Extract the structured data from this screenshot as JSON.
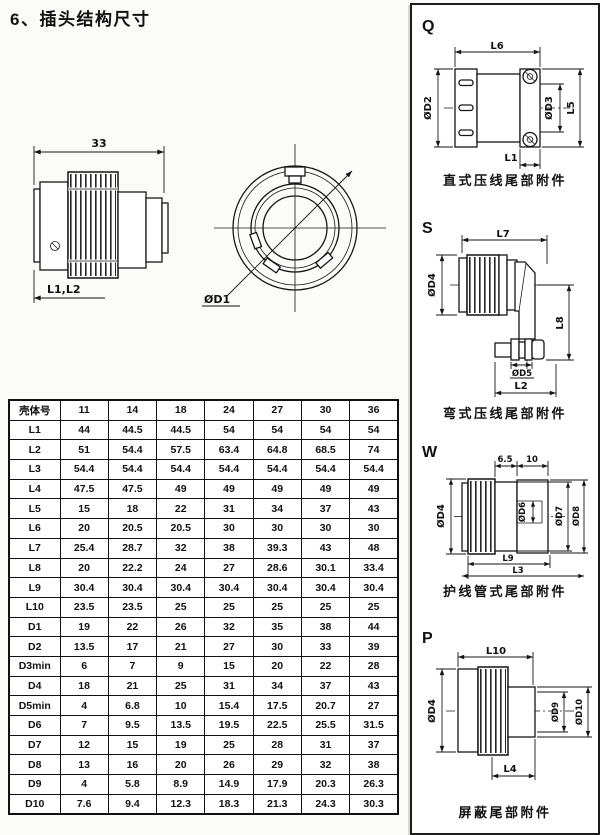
{
  "page": {
    "title": "6、插头结构尺寸"
  },
  "colors": {
    "ink": "#161616",
    "paper": "#ffffff"
  },
  "drawings": {
    "side_view": {
      "dim_width": "33",
      "dim_length": "L1,L2"
    },
    "front_view": {
      "dim_diameter": "ØD1"
    }
  },
  "table": {
    "header": [
      "壳体号",
      "11",
      "14",
      "18",
      "24",
      "27",
      "30",
      "36"
    ],
    "rows": [
      {
        "label": "L1",
        "values": [
          "44",
          "44.5",
          "44.5",
          "54",
          "54",
          "54",
          "54"
        ]
      },
      {
        "label": "L2",
        "values": [
          "51",
          "54.4",
          "57.5",
          "63.4",
          "64.8",
          "68.5",
          "74"
        ]
      },
      {
        "label": "L3",
        "values": [
          "54.4",
          "54.4",
          "54.4",
          "54.4",
          "54.4",
          "54.4",
          "54.4"
        ]
      },
      {
        "label": "L4",
        "values": [
          "47.5",
          "47.5",
          "49",
          "49",
          "49",
          "49",
          "49"
        ]
      },
      {
        "label": "L5",
        "values": [
          "15",
          "18",
          "22",
          "31",
          "34",
          "37",
          "43"
        ]
      },
      {
        "label": "L6",
        "values": [
          "20",
          "20.5",
          "20.5",
          "30",
          "30",
          "30",
          "30"
        ]
      },
      {
        "label": "L7",
        "values": [
          "25.4",
          "28.7",
          "32",
          "38",
          "39.3",
          "43",
          "48"
        ]
      },
      {
        "label": "L8",
        "values": [
          "20",
          "22.2",
          "24",
          "27",
          "28.6",
          "30.1",
          "33.4"
        ]
      },
      {
        "label": "L9",
        "values": [
          "30.4",
          "30.4",
          "30.4",
          "30.4",
          "30.4",
          "30.4",
          "30.4"
        ]
      },
      {
        "label": "L10",
        "values": [
          "23.5",
          "23.5",
          "25",
          "25",
          "25",
          "25",
          "25"
        ]
      },
      {
        "label": "D1",
        "values": [
          "19",
          "22",
          "26",
          "32",
          "35",
          "38",
          "44"
        ]
      },
      {
        "label": "D2",
        "values": [
          "13.5",
          "17",
          "21",
          "27",
          "30",
          "33",
          "39"
        ]
      },
      {
        "label": "D3min",
        "values": [
          "6",
          "7",
          "9",
          "15",
          "20",
          "22",
          "28"
        ]
      },
      {
        "label": "D4",
        "values": [
          "18",
          "21",
          "25",
          "31",
          "34",
          "37",
          "43"
        ]
      },
      {
        "label": "D5min",
        "values": [
          "4",
          "6.8",
          "10",
          "15.4",
          "17.5",
          "20.7",
          "27"
        ]
      },
      {
        "label": "D6",
        "values": [
          "7",
          "9.5",
          "13.5",
          "19.5",
          "22.5",
          "25.5",
          "31.5"
        ]
      },
      {
        "label": "D7",
        "values": [
          "12",
          "15",
          "19",
          "25",
          "28",
          "31",
          "37"
        ]
      },
      {
        "label": "D8",
        "values": [
          "13",
          "16",
          "20",
          "26",
          "29",
          "32",
          "38"
        ]
      },
      {
        "label": "D9",
        "values": [
          "4",
          "5.8",
          "8.9",
          "14.9",
          "17.9",
          "20.3",
          "26.3"
        ]
      },
      {
        "label": "D10",
        "values": [
          "7.6",
          "9.4",
          "12.3",
          "18.3",
          "21.3",
          "24.3",
          "30.3"
        ]
      }
    ]
  },
  "right_panel": {
    "sections": [
      {
        "letter": "Q",
        "caption": "直式压线尾部附件",
        "dims": {
          "top": "L6",
          "left": "ØD2",
          "inner": "ØD3",
          "right": "L5",
          "bottom": "L1"
        }
      },
      {
        "letter": "S",
        "caption": "弯式压线尾部附件",
        "dims": {
          "top": "L7",
          "left": "ØD4",
          "right": "L8",
          "dia_bottom": "ØD5",
          "bottom": "L2"
        }
      },
      {
        "letter": "W",
        "caption": "护线管式尾部附件",
        "dims": {
          "top_a": "6.5",
          "top_b": "10",
          "left": "ØD4",
          "dia_inner": "ØD6",
          "dia_mid": "ØD7",
          "dia_outer": "ØD8",
          "bottom_a": "L9",
          "bottom_b": "L3"
        }
      },
      {
        "letter": "P",
        "caption": "屏蔽尾部附件",
        "dims": {
          "top": "L10",
          "left": "ØD4",
          "dia_inner": "ØD9",
          "dia_outer": "ØD10",
          "bottom": "L4"
        }
      }
    ]
  }
}
